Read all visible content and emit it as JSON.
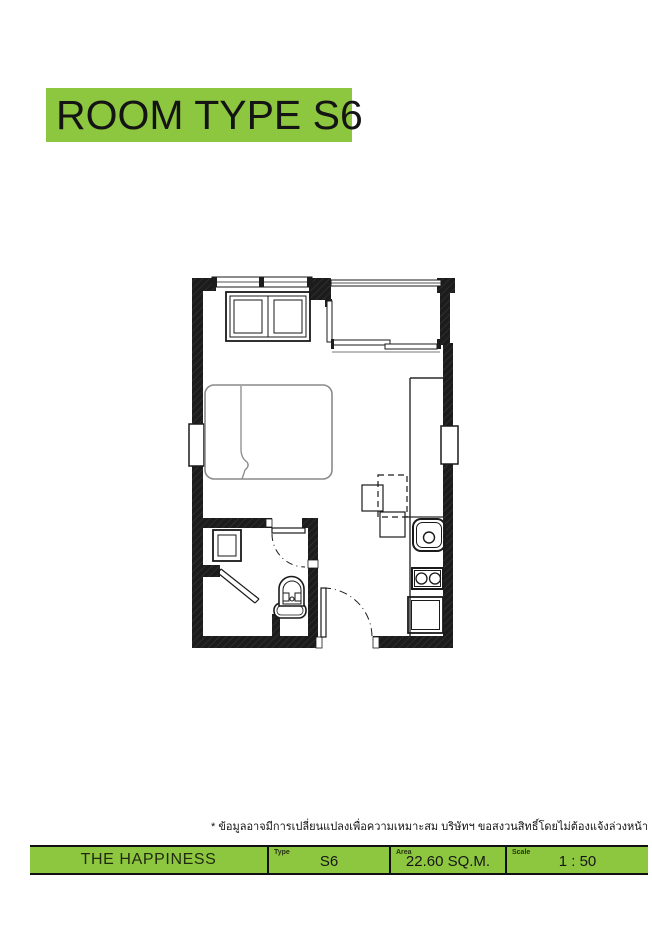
{
  "page": {
    "background": "#ffffff"
  },
  "colors": {
    "accent_green": "#8dc63f",
    "wall_black": "#1c1c1c",
    "furniture_gray": "#8a8a8a",
    "text_dark": "#1a1a1a"
  },
  "header": {
    "title": "ROOM TYPE S6"
  },
  "floor_plan": {
    "fixtures": [
      "window",
      "wardrobe",
      "balcony-parapet",
      "sliding-door",
      "bed",
      "left-wall-niche",
      "right-wall-niche",
      "bathroom-door",
      "washbasin",
      "shower-screen",
      "toilet",
      "entry-door",
      "dining-table",
      "stool",
      "kitchen-counter",
      "sink",
      "stove",
      "base-cabinet"
    ]
  },
  "disclaimer": "* ข้อมูลอาจมีการเปลี่ยนแปลงเพื่อความเหมาะสม บริษัทฯ ขอสงวนสิทธิ์โดยไม่ต้องแจ้งล่วงหน้า",
  "footer": {
    "brand": "THE HAPPINESS",
    "cells": [
      {
        "label": "Type",
        "value": "S6"
      },
      {
        "label": "Area",
        "value": "22.60 SQ.M."
      },
      {
        "label": "Scale",
        "value": "1 : 50"
      }
    ]
  }
}
